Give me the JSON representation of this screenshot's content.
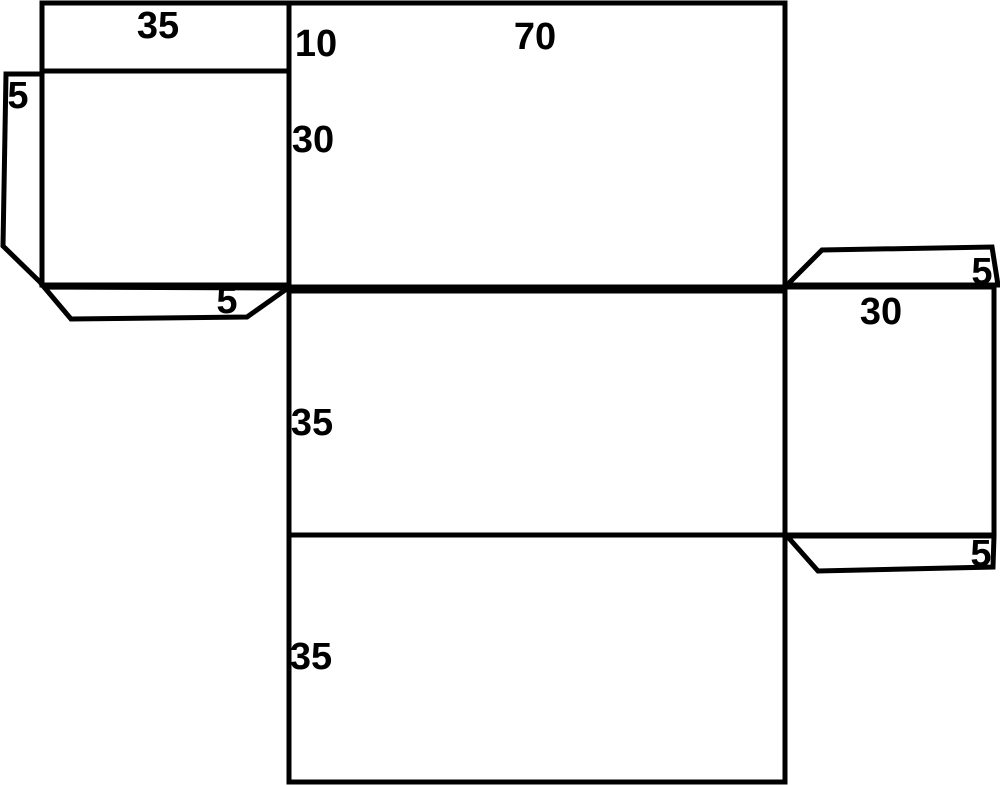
{
  "diagram": {
    "background_color": "#ffffff",
    "line_color": "#000000",
    "labels": {
      "top_left_flap": "35",
      "top_panel_edge": "10",
      "top_panel_width": "70",
      "top_panel_height": "30",
      "left_edge_flap": "5",
      "left_bottom_flap": "5",
      "middle_panel_height": "35",
      "right_panel_width": "30",
      "top_right_flap": "5",
      "bottom_right_flap": "5",
      "bottom_panel_height": "35"
    }
  }
}
